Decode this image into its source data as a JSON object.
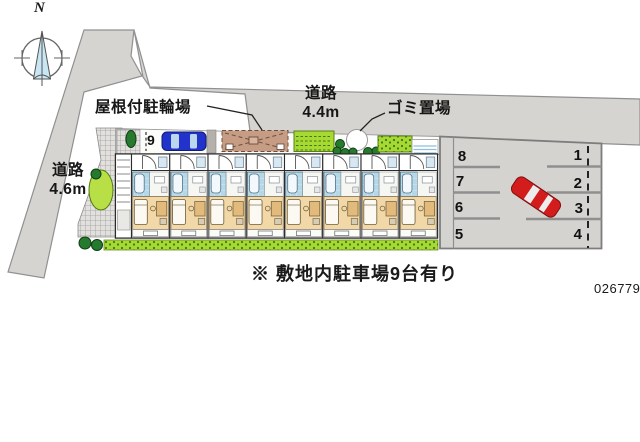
{
  "compass": {
    "north": "N"
  },
  "annotations": {
    "covered_bicycle_parking": "屋根付駐輪場",
    "garbage_area": "ゴミ置場",
    "road_top": {
      "name": "道路",
      "width": "4.4m"
    },
    "road_left": {
      "name": "道路",
      "width": "4.6m"
    },
    "site_note": "※ 敷地内駐車場9台有り",
    "plan_number": "026779"
  },
  "parking": {
    "driveway_space": "9",
    "left_column": [
      "8",
      "7",
      "6",
      "5"
    ],
    "right_column": [
      "1",
      "2",
      "3",
      "4"
    ]
  },
  "building": {
    "unit_count": 8
  },
  "colors": {
    "road": "#d6d4d1",
    "parking_lot": "#d5d3d0",
    "hedge": "#a8d832",
    "bush": "#267a2e",
    "bicycle_shelter": "#c69c84",
    "car_blue": "#2233cc",
    "car_red": "#d31c1c",
    "compass_needle": "#c9e6f4",
    "room_tan": "#f2d8a6",
    "wet_area_blue": "#b4d8e8"
  }
}
